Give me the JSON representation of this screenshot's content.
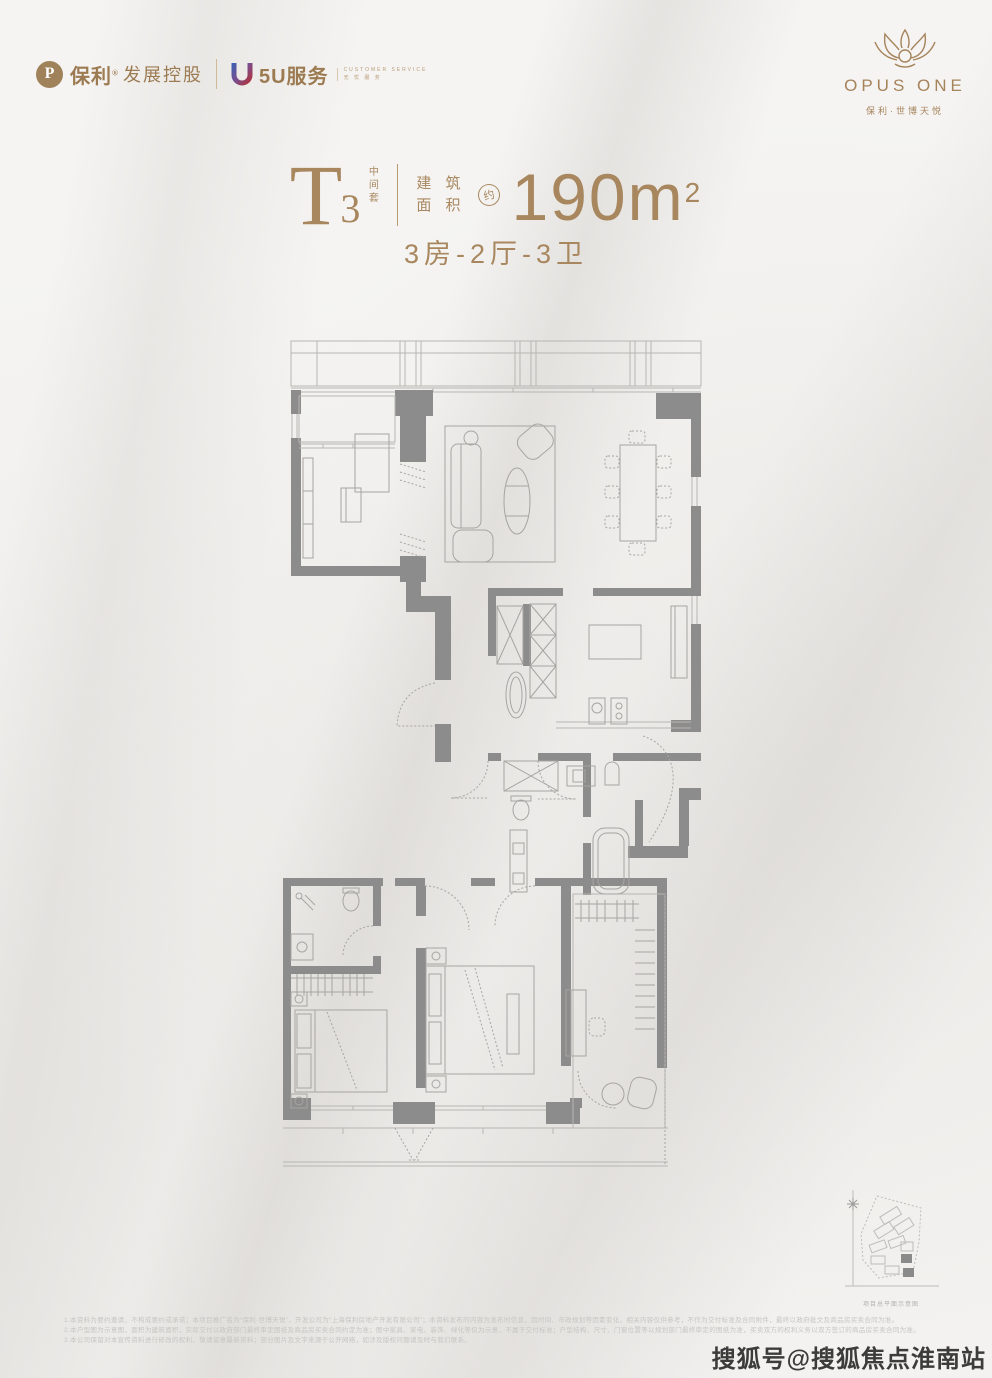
{
  "header": {
    "poly": {
      "roundel": "P",
      "brand": "保利",
      "reg": "®",
      "suffix": "发展控股"
    },
    "wuyou": {
      "name": "5U服务",
      "tagline_en": "CUSTOMER SERVICE",
      "tagline_cn": "无 忧 服 务"
    },
    "opus": {
      "name": "OPUS ONE",
      "subtitle": "保利·世博天悦"
    }
  },
  "title": {
    "type_letter": "T",
    "type_number": "3",
    "type_tag": "中间套",
    "area_label_1": "建 筑",
    "area_label_2": "面 积",
    "approx": "约",
    "area_value": "190m",
    "area_sup": "2",
    "layout": "3房-2厅-3卫"
  },
  "siteplan": {
    "caption": "项目总平面示意图"
  },
  "disclaimer": {
    "line1": "1.本资料为要约邀请，不构成要约或承诺；本项目推广名为“保利·世博天悦”，开发公司为“上海保利房地产开发有限公司”；本资料发布的内容为发布时信息，因时间、市政规划等因素变化，相关内容仅供参考，不作为交付标准及合同附件，最终以政府批文及商品房买卖合同为准。",
    "line2": "2.本户型图为示意图，面积为建筑面积，实际交付以政府部门最终审定图纸及商品房买卖合同约定为准；图中家具、家电、装饰、绿化等仅为示意，不属于交付标准；户型结构、尺寸、门窗位置等以规划部门最终审定的图纸为准，买卖双方的权利义务以双方签订的商品房买卖合同为准。",
    "line3": "3.本公司保留对本宣传资料进行修改的权利，敬请留意最新资料；部分图片及文字来源于公开网络，如涉及版权问题请及时与我们联系。"
  },
  "watermark": "搜狐号@搜狐焦点淮南站",
  "colors": {
    "accent": "#a8875f",
    "wall": "#8c8c8c",
    "line": "#b7b6b3"
  }
}
